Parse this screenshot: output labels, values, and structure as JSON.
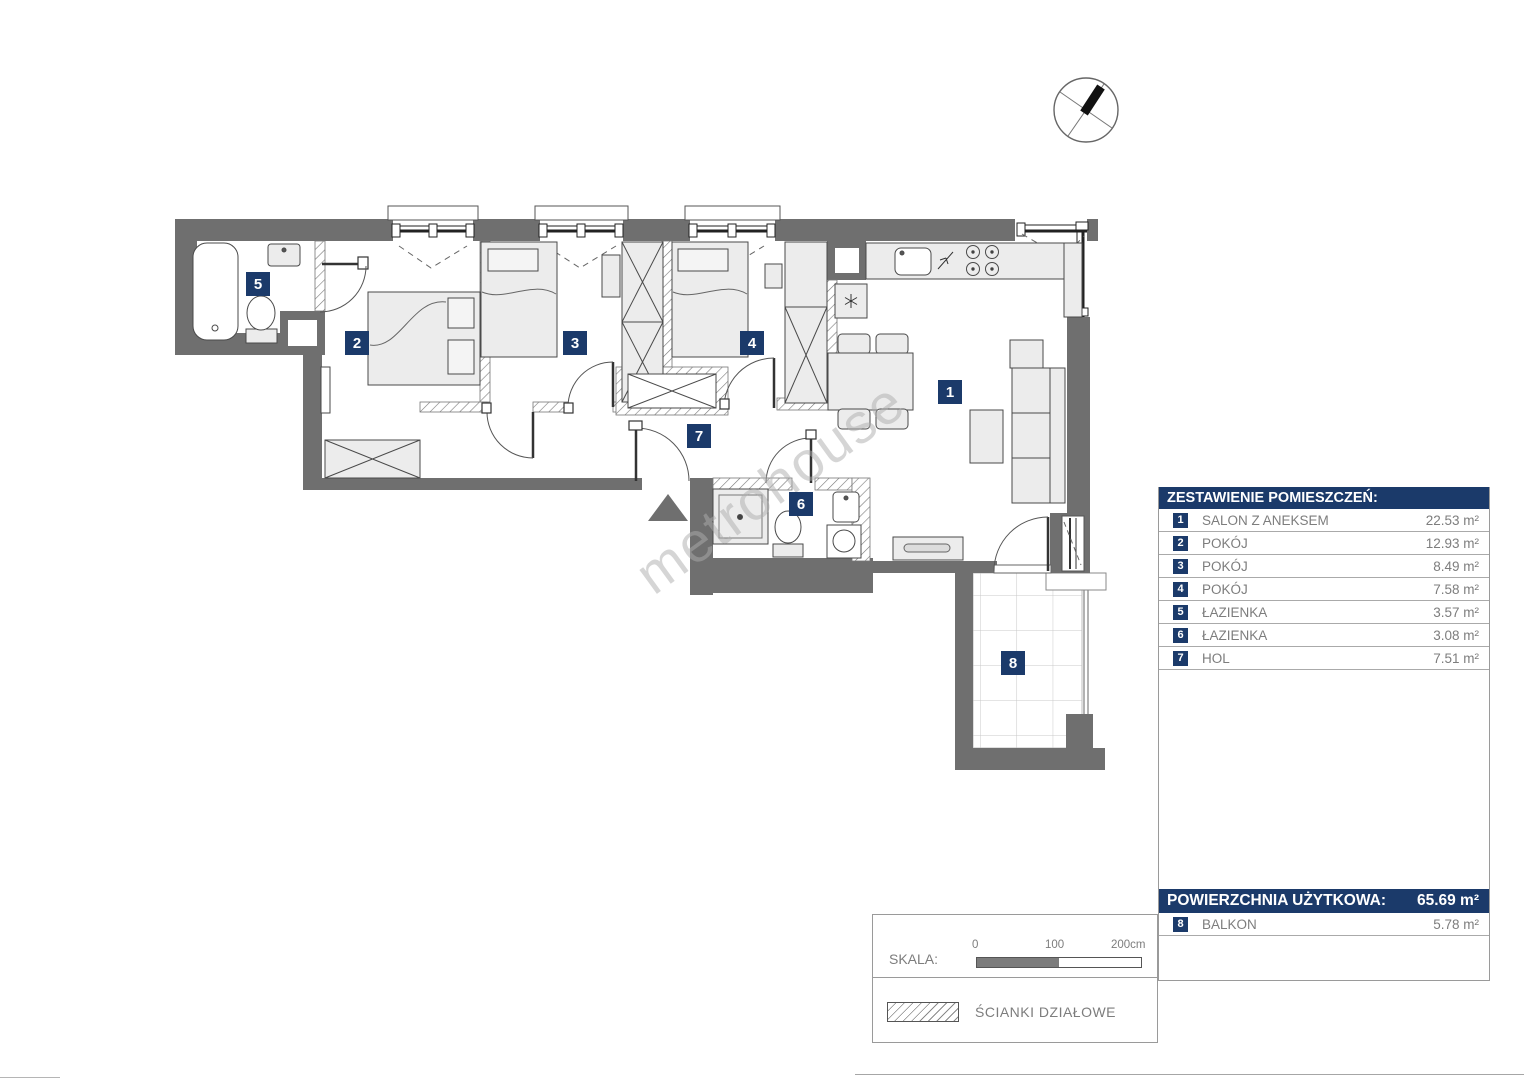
{
  "panel": {
    "header": "ZESTAWIENIE POMIESZCZEŃ:",
    "rooms": [
      {
        "num": "1",
        "label": "SALON Z ANEKSEM",
        "area": "22.53 m²"
      },
      {
        "num": "2",
        "label": "POKÓJ",
        "area": "12.93 m²"
      },
      {
        "num": "3",
        "label": "POKÓJ",
        "area": "8.49 m²"
      },
      {
        "num": "4",
        "label": "POKÓJ",
        "area": "7.58 m²"
      },
      {
        "num": "5",
        "label": "ŁAZIENKA",
        "area": "3.57 m²"
      },
      {
        "num": "6",
        "label": "ŁAZIENKA",
        "area": "3.08 m²"
      },
      {
        "num": "7",
        "label": "HOL",
        "area": "7.51 m²"
      }
    ],
    "total_label": "POWIERZCHNIA UŻYTKOWA:",
    "total_value": "65.69 m²",
    "balcony": {
      "num": "8",
      "label": "BALKON",
      "area": "5.78 m²"
    }
  },
  "legend": {
    "scale_label": "SKALA:",
    "scale_ticks": [
      "0",
      "100",
      "200cm"
    ],
    "partition_label": "ŚCIANKI DZIAŁOWE"
  },
  "plan": {
    "watermark": "metrohouse",
    "badges": [
      {
        "num": "1"
      },
      {
        "num": "2"
      },
      {
        "num": "3"
      },
      {
        "num": "4"
      },
      {
        "num": "5"
      },
      {
        "num": "6"
      },
      {
        "num": "7"
      },
      {
        "num": "8"
      }
    ]
  },
  "colors": {
    "navy": "#1b3a6a",
    "wall": "#6f6f6f"
  }
}
